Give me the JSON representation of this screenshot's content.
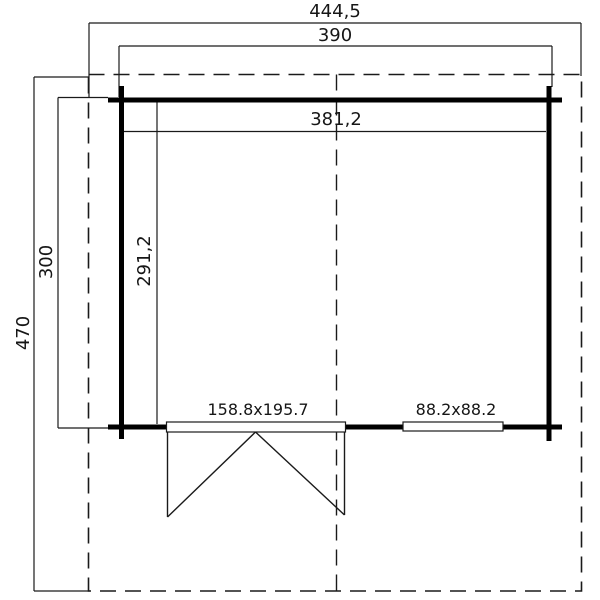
{
  "plan": {
    "title": "cabin-floor-plan",
    "colors": {
      "background": "#ffffff",
      "wall": "#000000",
      "line": "#1a1a1a"
    },
    "labels": {
      "overall_width": "444,5",
      "frame_width": "390",
      "interior_width": "381,2",
      "overall_depth": "470",
      "frame_depth": "300",
      "interior_depth": "291,2",
      "door_size": "158.8x195.7",
      "window_size": "88.2x88.2"
    }
  }
}
